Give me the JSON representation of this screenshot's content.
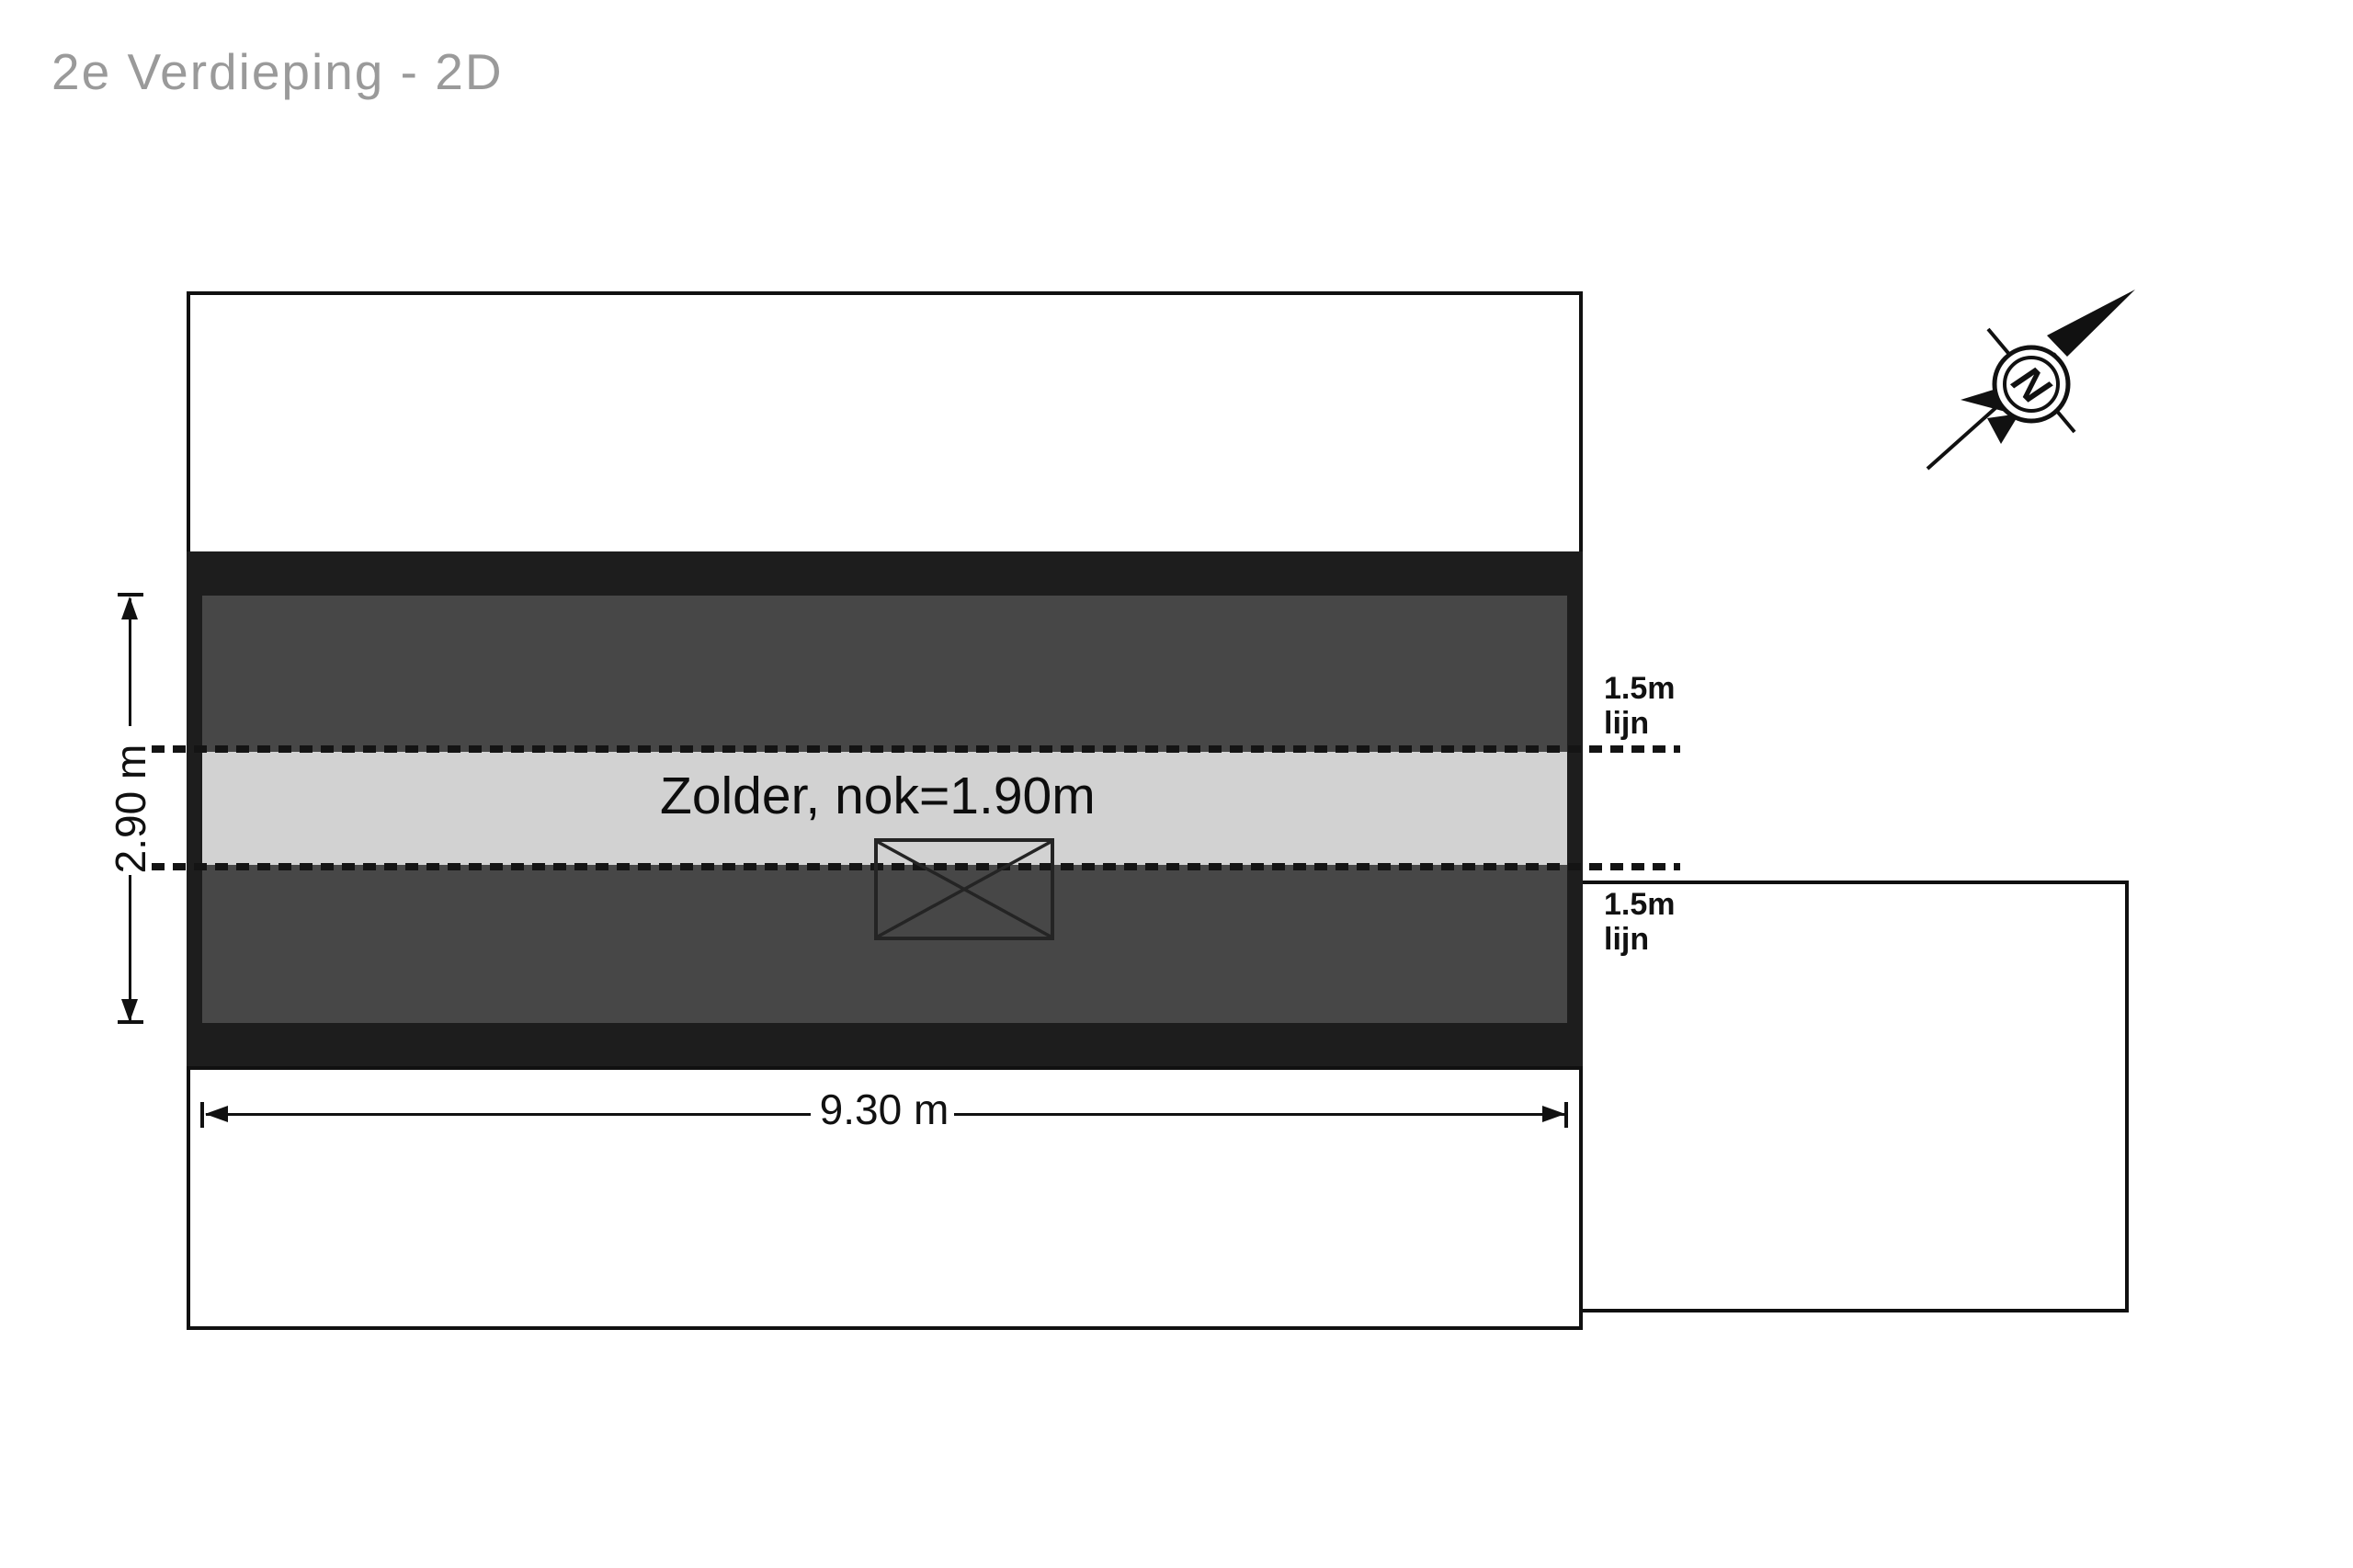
{
  "header": {
    "title": "2e Verdieping - 2D"
  },
  "floorplan": {
    "room_label": "Zolder, nok=1.90m",
    "headroom_top_label": "1.5m\nlijn",
    "headroom_bottom_label": "1.5m\nlijn",
    "dimension_width": "9.30 m",
    "dimension_height": "2.90 m",
    "compass_letter": "N",
    "colors": {
      "wall_black": "#1d1d1d",
      "floor_dark_gray": "#474747",
      "headroom_band_gray": "#d2d2d2",
      "line_black": "#141414",
      "title_gray": "#9a9a9a",
      "background": "#ffffff"
    }
  }
}
